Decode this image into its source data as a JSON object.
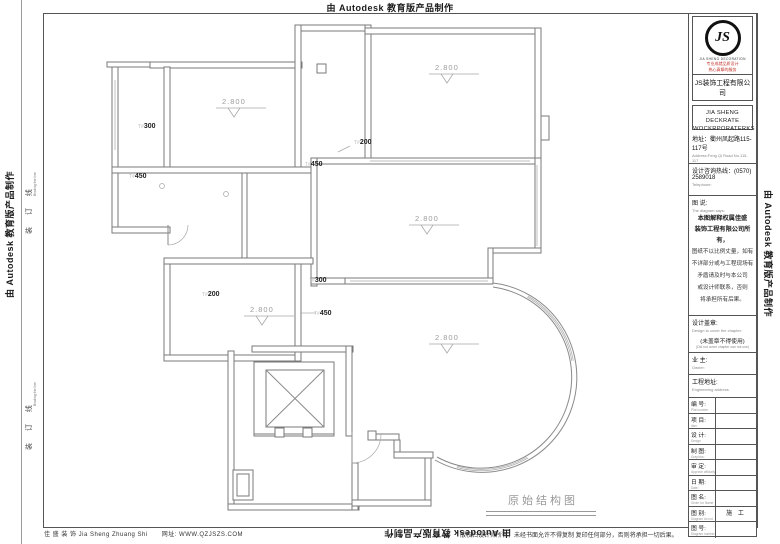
{
  "banner": "由 Autodesk 教育版产品制作",
  "binding": {
    "cn": "装 订 线",
    "en": "Binding the line"
  },
  "title_block": {
    "logo_glyph": "JS",
    "logo_caption": "JIA SHENG DECORATION",
    "slogan1": "专业成就品质设计",
    "slogan2": "热心真挚的服务",
    "company_cn": "JS装饰工程有限公司",
    "company_en1": "JIA SHENG DECKRATE",
    "company_en2": "WOCKRPORATERKS",
    "address_cn": "地址：衢州凤起路115-117号",
    "address_en": "Address:Feng Qi Road No.115-117",
    "phone_cn": "设计咨询热线：(0570) 2589018",
    "phone_en": "Telephone:",
    "note_title_cn": "图 说:",
    "note_title_en": "The diagram says:",
    "note_bold1": "本图解释权属佳盛",
    "note_bold2": "装饰工程有限公司所有，",
    "note_line1": "图纸不以比例丈量，如有",
    "note_line2": "不详部分或与工程现场有",
    "note_line3": "矛盾请及时与本公司",
    "note_line4": "或设计师联系，否则",
    "note_line5": "将承担所有后果。",
    "seal_cn": "设计盖章:",
    "seal_en": "Design to cover the chapter:",
    "seal_note_cn": "(未盖章不得使用)",
    "seal_note_en": "(Did not cover chapter can not use)",
    "owner_cn": "业 主:",
    "owner_en": "Owner:",
    "site_cn": "工程地址:",
    "site_en": "Engineering address",
    "rows": [
      {
        "cn": "编 号:",
        "en": "Plat number",
        "value": ""
      },
      {
        "cn": "项 目:",
        "en": "Item",
        "value": ""
      },
      {
        "cn": "设 计:",
        "en": "Design",
        "value": ""
      },
      {
        "cn": "制 图:",
        "en": "Graphics:",
        "value": ""
      },
      {
        "cn": "审 定:",
        "en": "Approve officially",
        "value": ""
      },
      {
        "cn": "日 期:",
        "en": "Date:",
        "value": ""
      },
      {
        "cn": "图 名:",
        "en": "Given for Name",
        "value": ""
      },
      {
        "cn": "图 别:",
        "en": "Diagram do not",
        "value": "施 工"
      },
      {
        "cn": "图 号:",
        "en": "Diagram number",
        "value": ""
      }
    ]
  },
  "footer": {
    "company": "佳 盛 装 饰 Jia Sheng Zhuang Shi",
    "website": "网址: WWW.QZJSZS.COM",
    "copyright": "版权归设计师所有，未经书面允许不得复制 复印任何部分，否则将承担一切后果。"
  },
  "plan": {
    "title": "原始结构图",
    "height_labels": [
      {
        "text": "2.800"
      },
      {
        "text": "2.800"
      },
      {
        "text": "2.800"
      },
      {
        "text": "2.800"
      },
      {
        "text": "2.800"
      }
    ],
    "beam_labels": [
      {
        "prefix": "T#",
        "value": "300"
      },
      {
        "prefix": "T#",
        "value": "200"
      },
      {
        "prefix": "T#",
        "value": "450"
      },
      {
        "prefix": "T#",
        "value": "450"
      },
      {
        "prefix": "T#",
        "value": "300"
      },
      {
        "prefix": "T#",
        "value": "200"
      },
      {
        "prefix": "T#",
        "value": "450"
      }
    ]
  }
}
